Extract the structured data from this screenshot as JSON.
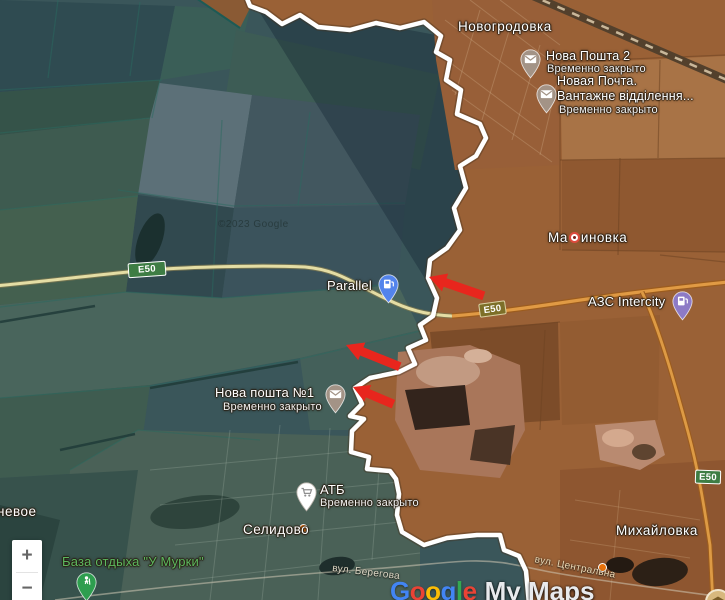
{
  "attribution": "©2023 Google",
  "logo": {
    "letters": [
      "G",
      "o",
      "o",
      "g",
      "l",
      "e"
    ],
    "suffix": "My Maps"
  },
  "controls": {
    "zoom_in": "+",
    "zoom_out": "−"
  },
  "road_badges": {
    "left": "E50",
    "mid": "E50",
    "right": "E50"
  },
  "towns": {
    "novogrodovka": "Новогродовка",
    "marinovka": {
      "full": "Мариновка",
      "before": "Ма",
      "after": "иновка"
    },
    "selidovo": "Селидово",
    "mikhaylovka": "Михайловка",
    "partial_west": "невое"
  },
  "streets": {
    "beregova": "вул. Берегова",
    "tsentralna": "вул. Центральна"
  },
  "places": {
    "nova_poshta_2": {
      "name": "Нова Пошта 2",
      "status": "Временно закрыто",
      "icon": "envelope"
    },
    "novaya_pochta": {
      "name_line1": "Новая Почта.",
      "name_line2": "Вантажне відділення...",
      "status": "Временно закрыто",
      "icon": "envelope"
    },
    "nova_poshta_1": {
      "name": "Нова пошта №1",
      "status": "Временно закрыто",
      "icon": "envelope"
    },
    "parallel": {
      "name": "Parallel",
      "icon": "fuel-pump"
    },
    "azs_intercity": {
      "name": "АЗС Intercity",
      "icon": "fuel-pump"
    },
    "atb": {
      "name": "АТБ",
      "status": "Временно закрыто",
      "icon": "shopping-cart"
    },
    "murki": {
      "name": "База отдыха \"У Мурки\"",
      "icon": "hiker"
    }
  },
  "annotations": {
    "frontline": "white boundary line",
    "arrow_count": 3,
    "arrow_direction": "pointing west"
  },
  "colors": {
    "frontline": "#ffffff",
    "arrow_red": "#e8261d",
    "west_overlay": "#3a565a",
    "east_overlay": "#9a6136",
    "road_e50_east": "#e09a44",
    "road_e50_west": "#e4dda4",
    "badge_green": "#3e7d44",
    "badge_olive": "#7d6f28",
    "pin_post": "#a39386",
    "pin_fuel_blue": "#5384ec",
    "pin_fuel_purple": "#8d7ac6",
    "pin_store": "#ffffff",
    "pin_recreation": "#2e9e4f",
    "dot_orange": "#e8710a",
    "label_green": "#5cb85f"
  }
}
